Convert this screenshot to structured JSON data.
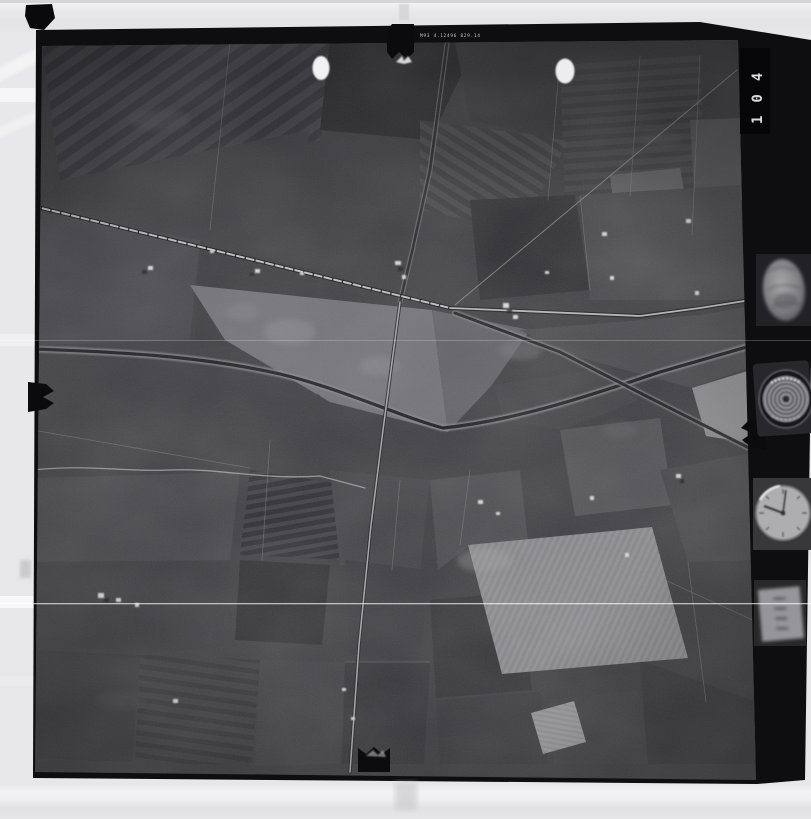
{
  "document": {
    "type": "scanned black-and-white aerial survey photograph (film frame)",
    "frame_number": "104",
    "edge_stamp_text": "M93 4.12496 829.14",
    "frame_number_note": "printed sideways (rotated 90) on dark film-edge patch, top right"
  },
  "film": {
    "border_color": "#0e0e10",
    "photo_base_color": "#3e3e42",
    "page_background": "#e7e7e9",
    "scratch_line_color": "#ffffff"
  },
  "marginalia": {
    "instruments": [
      {
        "name": "level-bubble-gauge",
        "shape": "blurred oval",
        "position": "right strip, upper"
      },
      {
        "name": "altimeter-dial",
        "shape": "concentric-ring dial with arc lettering",
        "position": "right strip, upper middle"
      },
      {
        "name": "clock-dial",
        "shape": "watch face, hands near 12 and 9",
        "position": "right strip, lower middle"
      },
      {
        "name": "counter-panel",
        "shape": "small blurred rectangle with dark digits column",
        "position": "right strip, lower"
      }
    ],
    "fiducial_marks": [
      "top-center-notch-with-butterfly",
      "bottom-center-notch",
      "left-edge-jagged-notch",
      "right-edge-jagged-notch",
      "top-left-corner-blob",
      "white-dot-fiducial-left",
      "white-dot-fiducial-right"
    ]
  },
  "scene": {
    "description": "Flat agricultural landscape: mosaic of dark and light fields, a railway joining a main road at a junction, a north-south tree-lined road, a meandering stream band, bright ploughed patches and scattered farmsteads",
    "features": [
      "railway-line-from-west",
      "main-road-east",
      "north-south-road",
      "southeast-tree-lined-road",
      "meandering-stream-band",
      "strip-fields",
      "bright-ploughed-triangle",
      "bright-field-bottom-right",
      "farmstead-clusters",
      "horizontal-film-scratch"
    ]
  }
}
